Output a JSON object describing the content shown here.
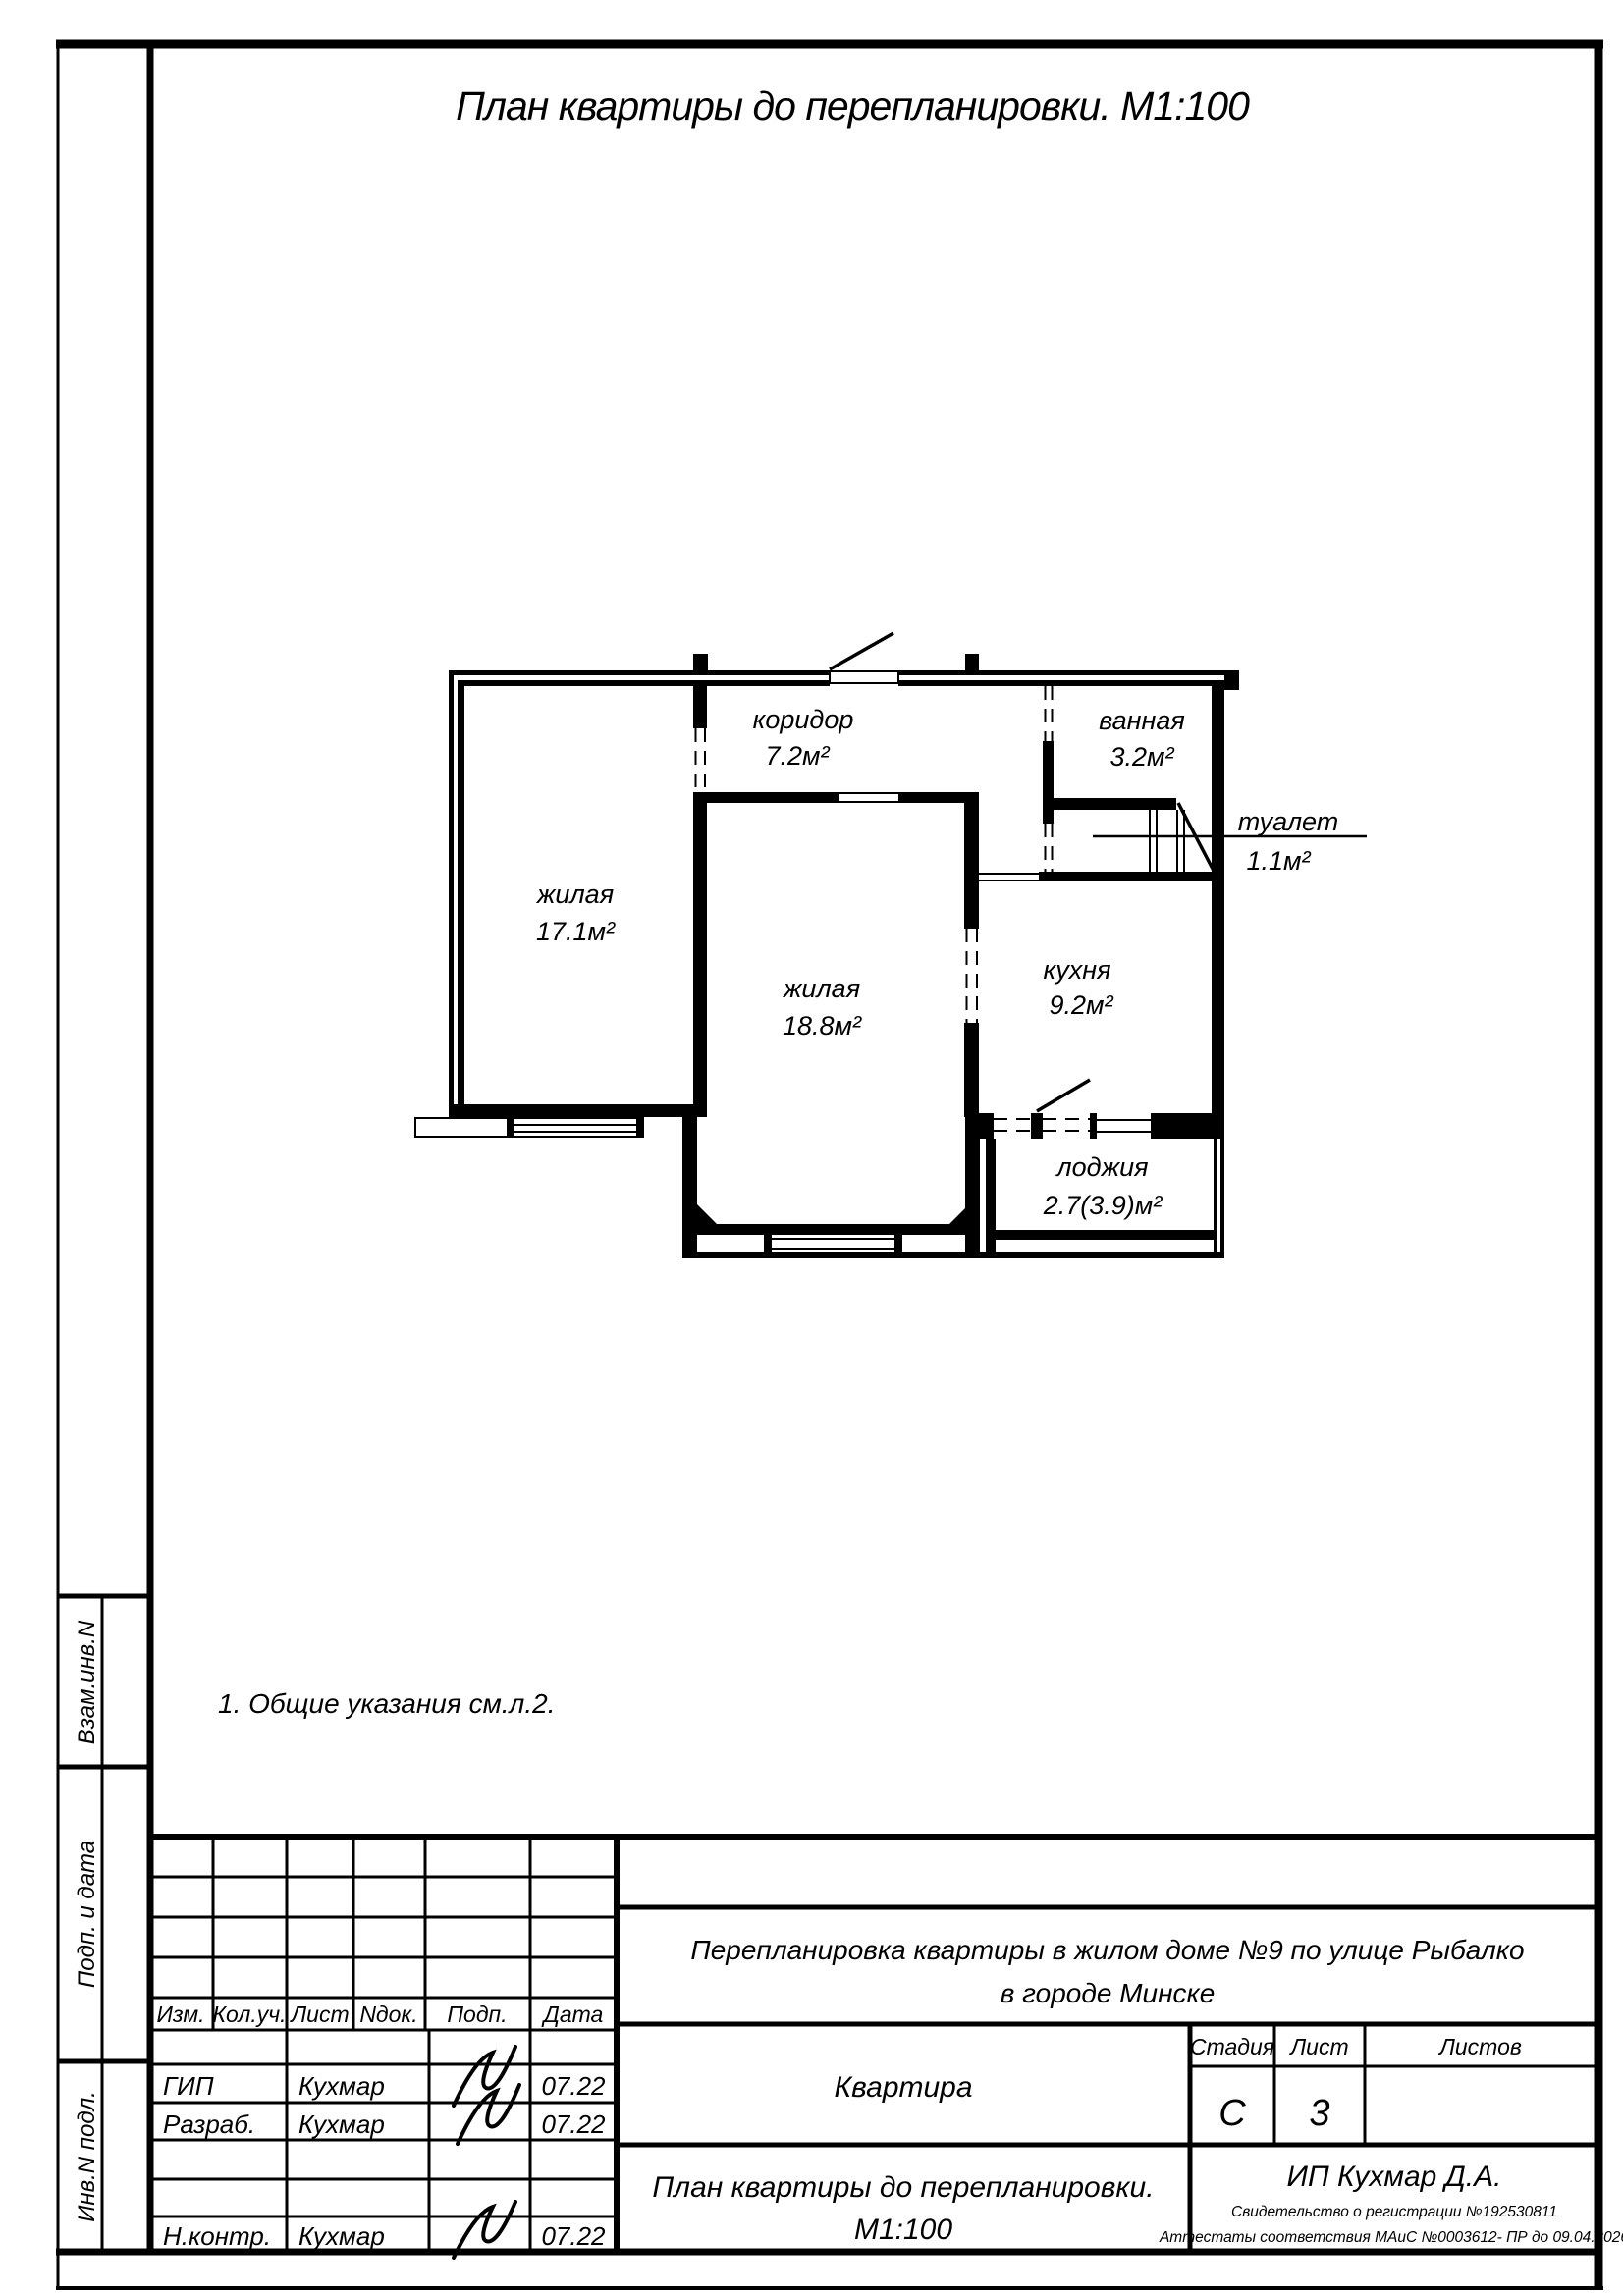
{
  "title": "План квартиры до перепланировки. М1:100",
  "note": "1. Общие указания см.л.2.",
  "plan": {
    "rooms": [
      {
        "name": "коридор",
        "area": "7.2м²"
      },
      {
        "name": "ванная",
        "area": "3.2м²"
      },
      {
        "name": "туалет",
        "area": "1.1м²"
      },
      {
        "name": "жилая",
        "area": "17.1м²"
      },
      {
        "name": "жилая",
        "area": "18.8м²"
      },
      {
        "name": "кухня",
        "area": "9.2м²"
      },
      {
        "name": "лоджия",
        "area": "2.7(3.9)м²"
      }
    ]
  },
  "margins": {
    "vzam": "Взам.инв.N",
    "podp_data": "Подп. и дата",
    "inv_podl": "Инв.N подл."
  },
  "stamp": {
    "columns": {
      "izm": "Изм.",
      "kolich": "Кол.уч.",
      "list": "Лист",
      "ndok": "Nдок.",
      "podp": "Подп.",
      "data": "Дата"
    },
    "rows": [
      {
        "role": "ГИП",
        "name": "Кухмар",
        "date": "07.22"
      },
      {
        "role": "Разраб.",
        "name": "Кухмар",
        "date": "07.22"
      },
      {
        "role": "Н.контр.",
        "name": "Кухмар",
        "date": "07.22"
      }
    ],
    "project": {
      "line1": "Перепланировка квартиры в жилом доме №9 по улице Рыбалко",
      "line2": "в городе Минске"
    },
    "object": "Квартира",
    "sheet_title": {
      "line1": "План квартиры до перепланировки.",
      "line2": "М1:100"
    },
    "stage": {
      "label": "Стадия",
      "value": "С"
    },
    "sheet": {
      "label": "Лист",
      "value": "3"
    },
    "sheets": {
      "label": "Листов",
      "value": ""
    },
    "firm": {
      "name": "ИП Кухмар Д.А.",
      "cert1": "Свидетельство о регистрации №192530811",
      "cert2": "Аттестаты соответствия МАиС  №0003612- ПР до  09.04.2026"
    }
  }
}
